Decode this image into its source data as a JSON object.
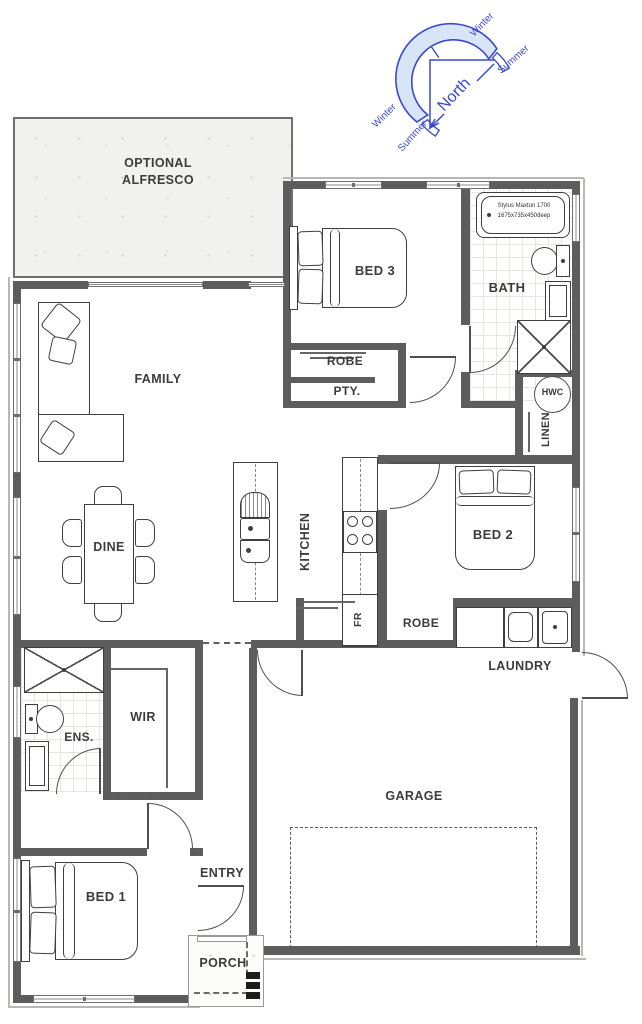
{
  "compass": {
    "north": "North",
    "winter_upper": "Winter",
    "summer_upper": "Summer",
    "winter_lower": "Winter",
    "summer_lower": "Summer"
  },
  "rooms": {
    "alfresco": {
      "line1": "OPTIONAL",
      "line2": "ALFRESCO"
    },
    "bed3": "BED 3",
    "robe_bed3": "ROBE",
    "pantry": "PTY.",
    "bath": "BATH",
    "hwc": "HWC",
    "linen": "LINEN",
    "family": "FAMILY",
    "kitchen": "KITCHEN",
    "bed2": "BED 2",
    "dine": "DINE",
    "fridge": "FR",
    "robe_bed2": "ROBE",
    "laundry": "LAUNDRY",
    "ensuite": "ENS.",
    "wir": "WIR",
    "garage": "GARAGE",
    "bed1": "BED 1",
    "entry": "ENTRY",
    "porch": "PORCH"
  },
  "fixtures": {
    "bath_model": "Stylus Maxton 1700",
    "bath_dimensions": "1675x735x450deep"
  },
  "colors": {
    "wall": "#5d5d5d",
    "label": "#3c3c3c",
    "compass_stroke": "#3a48d0",
    "compass_fill": "#d8e5f6",
    "alfresco_fill": "#f1f1ee"
  }
}
